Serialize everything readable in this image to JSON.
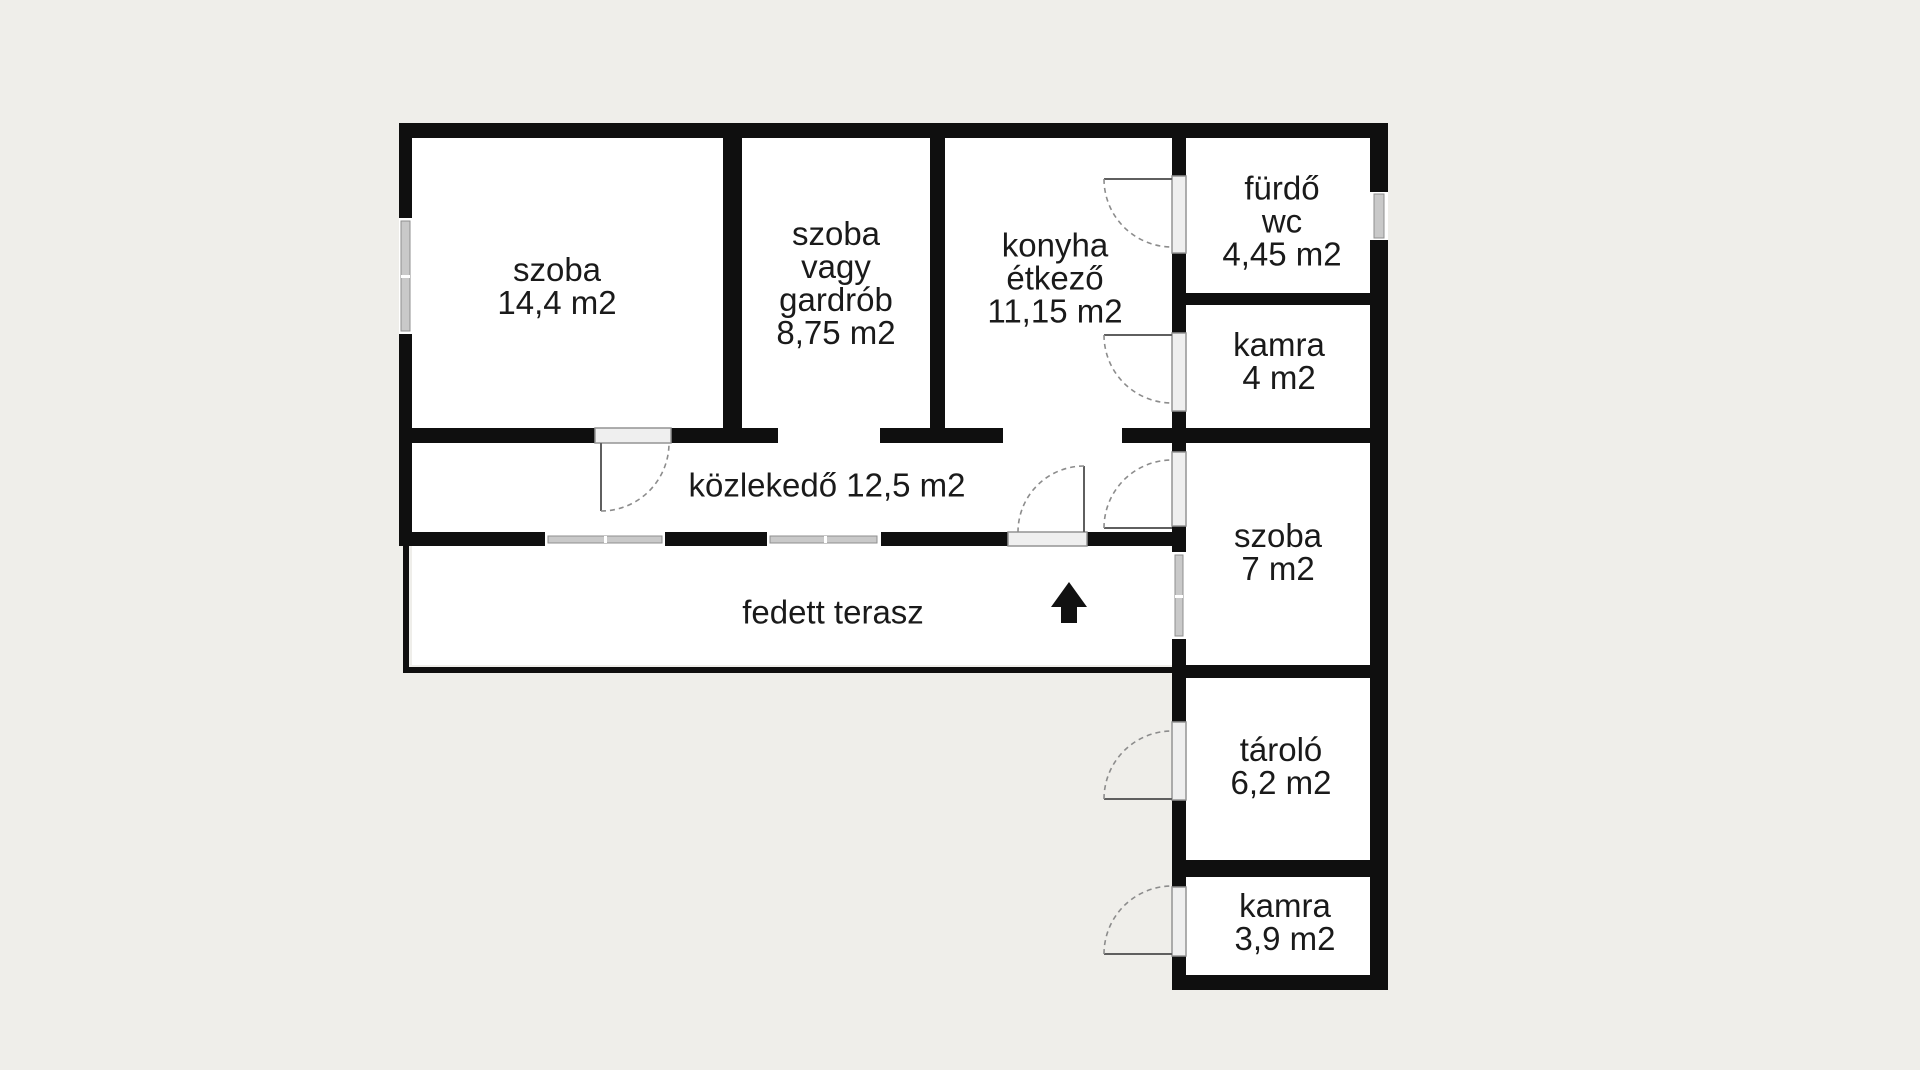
{
  "meta": {
    "canvas_width": 1920,
    "canvas_height": 1070,
    "type": "floor-plan"
  },
  "colors": {
    "background": "#efeeea",
    "paper": "#ffffff",
    "wall": "#0f0f0f",
    "window_bar": "#c9c9c9",
    "window_edge": "#8f8f8f",
    "threshold_fill": "#efefef",
    "threshold_edge": "#949494",
    "door_leaf": "#5f5f5f",
    "door_arc": "#8c8c8c",
    "text": "#1a1a1a"
  },
  "rooms": [
    {
      "id": "szoba-14-4",
      "cx": 557,
      "cy": 286,
      "lines": [
        "szoba",
        "14,4 m2"
      ]
    },
    {
      "id": "szoba-vagy-gardrob",
      "cx": 836,
      "cy": 283,
      "lines": [
        "szoba",
        "vagy",
        "gardrób",
        "8,75 m2"
      ]
    },
    {
      "id": "konyha-etkezo",
      "cx": 1055,
      "cy": 278,
      "lines": [
        "konyha",
        "étkező",
        "11,15 m2"
      ]
    },
    {
      "id": "furdo-wc",
      "cx": 1282,
      "cy": 221,
      "lines": [
        "fürdő",
        "wc",
        "4,45 m2"
      ]
    },
    {
      "id": "kamra-4",
      "cx": 1279,
      "cy": 361,
      "lines": [
        "kamra",
        "4 m2"
      ]
    },
    {
      "id": "kozlekedo",
      "cx": 827,
      "cy": 485,
      "lines": [
        "közlekedő 12,5 m2"
      ]
    },
    {
      "id": "szoba-7",
      "cx": 1278,
      "cy": 552,
      "lines": [
        "szoba",
        "7 m2"
      ]
    },
    {
      "id": "fedett-terasz",
      "cx": 833,
      "cy": 612,
      "lines": [
        "fedett terasz"
      ]
    },
    {
      "id": "tarolo",
      "cx": 1281,
      "cy": 766,
      "lines": [
        "tároló",
        "6,2 m2"
      ]
    },
    {
      "id": "kamra-3-9",
      "cx": 1285,
      "cy": 922,
      "lines": [
        "kamra",
        "3,9 m2"
      ]
    }
  ],
  "geometry": {
    "paper_rects": [
      [
        412,
        138,
        958,
        290
      ],
      [
        412,
        443,
        760,
        222
      ],
      [
        1186,
        443,
        184,
        532
      ],
      [
        778,
        428,
        102,
        15
      ],
      [
        1003,
        428,
        119,
        15
      ]
    ],
    "walls": [
      [
        399,
        123,
        989,
        15
      ],
      [
        399,
        138,
        13,
        80
      ],
      [
        399,
        334,
        13,
        212
      ],
      [
        403,
        546,
        6,
        126
      ],
      [
        403,
        667,
        769,
        6
      ],
      [
        1370,
        138,
        18,
        54
      ],
      [
        1370,
        240,
        18,
        750
      ],
      [
        723,
        138,
        19,
        290
      ],
      [
        930,
        138,
        15,
        305
      ],
      [
        1172,
        138,
        14,
        38
      ],
      [
        1172,
        253,
        14,
        80
      ],
      [
        1172,
        411,
        14,
        41
      ],
      [
        1172,
        526,
        14,
        26
      ],
      [
        1172,
        639,
        14,
        83
      ],
      [
        1172,
        800,
        14,
        87
      ],
      [
        1172,
        956,
        14,
        34
      ],
      [
        412,
        428,
        183,
        15
      ],
      [
        671,
        428,
        107,
        15
      ],
      [
        880,
        428,
        123,
        15
      ],
      [
        1122,
        428,
        266,
        15
      ],
      [
        399,
        532,
        146,
        14
      ],
      [
        665,
        532,
        102,
        14
      ],
      [
        881,
        532,
        127,
        14
      ],
      [
        1087,
        532,
        99,
        14
      ],
      [
        1186,
        293,
        184,
        12
      ],
      [
        1172,
        665,
        216,
        13
      ],
      [
        1172,
        860,
        216,
        17
      ],
      [
        1172,
        975,
        216,
        15
      ]
    ],
    "windows": [
      {
        "gap": [
          399,
          218,
          13,
          116
        ],
        "bar": [
          401,
          221,
          9,
          110
        ],
        "dividers": [
          [
            401,
            275,
            9,
            3
          ]
        ]
      },
      {
        "gap": [
          545,
          532,
          120,
          14
        ],
        "bar": [
          548,
          536,
          114,
          7
        ],
        "dividers": [
          [
            604,
            536,
            3,
            7
          ]
        ]
      },
      {
        "gap": [
          767,
          532,
          113,
          14
        ],
        "bar": [
          770,
          536,
          107,
          7
        ],
        "dividers": [
          [
            824,
            536,
            3,
            7
          ]
        ]
      },
      {
        "gap": [
          1172,
          552,
          14,
          87
        ],
        "bar": [
          1175,
          555,
          8,
          81
        ],
        "dividers": [
          [
            1175,
            595,
            8,
            3
          ]
        ]
      },
      {
        "gap": [
          1370,
          192,
          18,
          48
        ],
        "bar": [
          1374,
          194,
          10,
          44
        ],
        "dividers": []
      }
    ],
    "thresholds": [
      [
        595,
        428,
        76,
        15
      ],
      [
        1172,
        176,
        14,
        77
      ],
      [
        1172,
        333,
        14,
        78
      ],
      [
        1172,
        452,
        14,
        74
      ],
      [
        1008,
        532,
        79,
        14
      ],
      [
        1172,
        722,
        14,
        78
      ],
      [
        1172,
        887,
        14,
        69
      ]
    ],
    "door_leaves": [
      [
        601,
        443,
        601,
        511
      ],
      [
        1172,
        179,
        1104,
        179
      ],
      [
        1172,
        335,
        1104,
        335
      ],
      [
        1172,
        528,
        1104,
        528
      ],
      [
        1084,
        532,
        1084,
        466
      ],
      [
        1172,
        799,
        1104,
        799
      ],
      [
        1172,
        954,
        1104,
        954
      ]
    ],
    "door_arcs": [
      "M 601,511 A 68,68 0 0 0 669,443",
      "M 1104,179 A 68,68 0 0 0 1172,247",
      "M 1104,335 A 68,68 0 0 0 1172,403",
      "M 1104,528 A 68,68 0 0 1 1172,460",
      "M 1084,466 A 66,66 0 0 0 1018,532",
      "M 1104,799 A 68,68 0 0 1 1172,731",
      "M 1104,954 A 68,68 0 0 1 1172,886"
    ],
    "entrance_arrow": "1069,582 1051,607 1061,607 1061,623 1077,623 1077,607 1087,607"
  }
}
